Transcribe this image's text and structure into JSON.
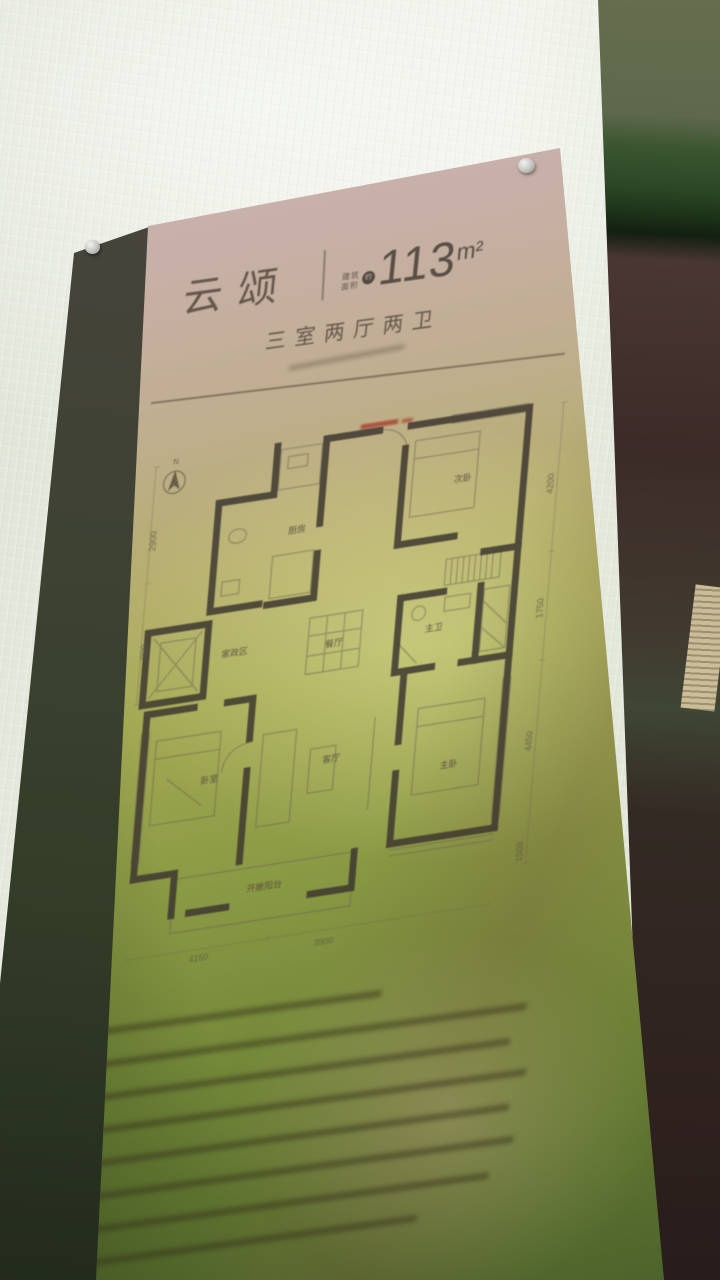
{
  "sign": {
    "title": "云颂",
    "area": {
      "prefix_top": "建筑",
      "prefix_bottom": "面积",
      "approx_badge": "约",
      "value": "113",
      "unit": "m²"
    },
    "layout_type": "三室两厅两卫"
  },
  "floor_plan": {
    "compass_label": "N",
    "rooms": {
      "kitchen": "厨房",
      "bedroom2": "次卧",
      "dining": "餐厅",
      "master_bath": "主卫",
      "utility": "家政区",
      "living": "客厅",
      "bedroom3": "卧室",
      "master_bedroom": "主卧",
      "balcony": "开敞阳台"
    },
    "dimensions": {
      "left": [
        "2900",
        "900"
      ],
      "right": [
        "4200",
        "1750",
        "4450",
        "1500"
      ],
      "bottom": [
        "4150",
        "3900"
      ]
    }
  },
  "colors": {
    "panel_pink": "#cdb5b3",
    "panel_olive": "#8e9c46",
    "panel_dark_green": "#4b622b",
    "stamp_red": "#a83a2c",
    "wall_white": "#eaede1"
  }
}
